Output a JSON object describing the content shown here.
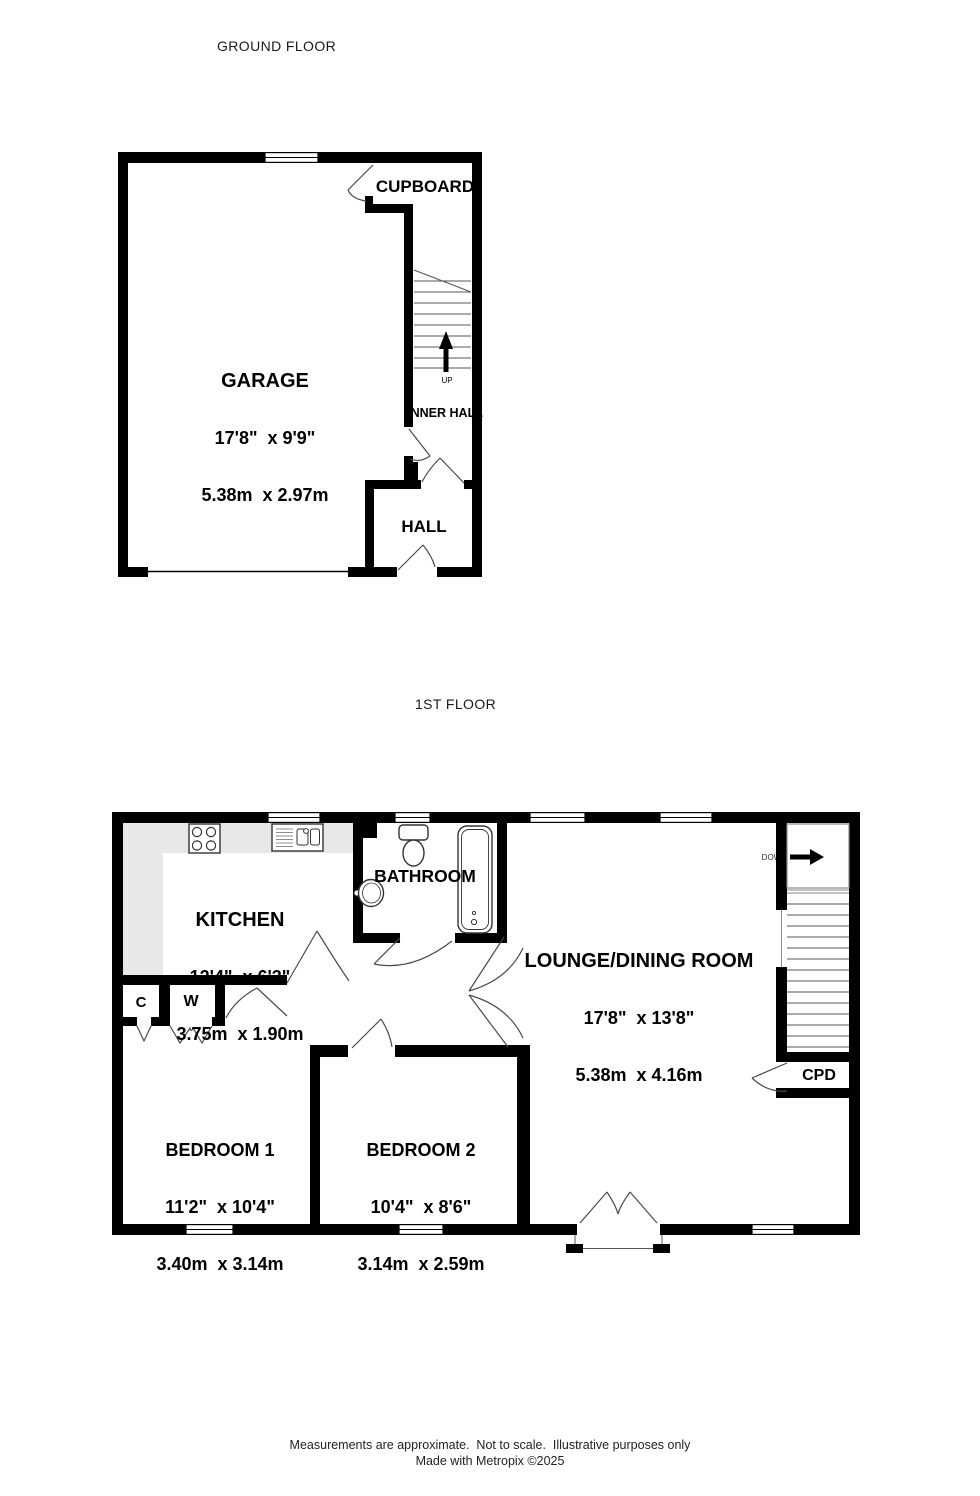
{
  "colors": {
    "wall": "#000000",
    "counter": "#e8e8e8",
    "door_line": "#4a4a4a",
    "step_line": "#555555",
    "background": "#ffffff",
    "text": "#000000"
  },
  "ground_floor": {
    "title": "GROUND FLOOR",
    "cupboard_label": "CUPBOARD",
    "garage": {
      "name": "GARAGE",
      "imperial": "17'8\"  x 9'9\"",
      "metric": "5.38m  x 2.97m"
    },
    "inner_hall_label": "INNER HALL",
    "hall_label": "HALL",
    "stairs_direction": "UP"
  },
  "first_floor": {
    "title": "1ST FLOOR",
    "kitchen": {
      "name": "KITCHEN",
      "imperial": "12'4\"  x 6'3\"",
      "metric": "3.75m  x 1.90m"
    },
    "bathroom_label": "BATHROOM",
    "lounge": {
      "name": "LOUNGE/DINING ROOM",
      "imperial": "17'8\"  x 13'8\"",
      "metric": "5.38m  x 4.16m"
    },
    "bedroom1": {
      "name": "BEDROOM 1",
      "imperial": "11'2\"  x 10'4\"",
      "metric": "3.40m  x 3.14m"
    },
    "bedroom2": {
      "name": "BEDROOM 2",
      "imperial": "10'4\"  x 8'6\"",
      "metric": "3.14m  x 2.59m"
    },
    "closet_c_label": "C",
    "closet_w_label": "W",
    "cupboard_label": "CPD",
    "stairs_direction": "DOWN"
  },
  "footer": {
    "line1": "Measurements are approximate.  Not to scale.  Illustrative purposes only",
    "line2": "Made with Metropix ©2025"
  }
}
